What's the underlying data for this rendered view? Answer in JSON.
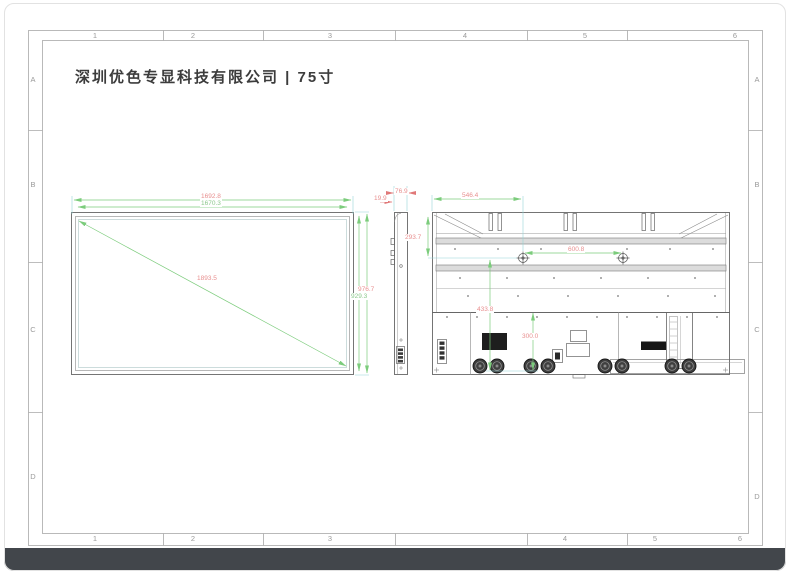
{
  "sheet": {
    "company_title": "深圳优色专显科技有限公司 | 75寸",
    "grid_columns": [
      "1",
      "2",
      "3",
      "4",
      "5",
      "6"
    ],
    "grid_rows": [
      "A",
      "B",
      "C",
      "D"
    ]
  },
  "dimensions": {
    "front_outer_width": "1692.8",
    "front_inner_width": "1670.3",
    "front_outer_height": "976.7",
    "front_inner_height": "929.3",
    "front_diagonal": "1893.5",
    "side_front_thickness": "19.9",
    "side_depth": "76.9",
    "back_edge_to_vesa_x": "546.4",
    "back_top_to_vesa_y": "293.7",
    "back_vesa_spacing_x": "600.8",
    "back_vesa_to_bottom": "433.8",
    "back_lower_span": "300.0"
  },
  "colors": {
    "dimension_line_green": "#7ccc7c",
    "extension_line_cyan": "#96d6d8",
    "dimension_text_red": "#e88f8f",
    "dimension_text_green": "#8cc88c",
    "drawing_line_grey": "#666666",
    "bottom_bar": "#42464b"
  }
}
